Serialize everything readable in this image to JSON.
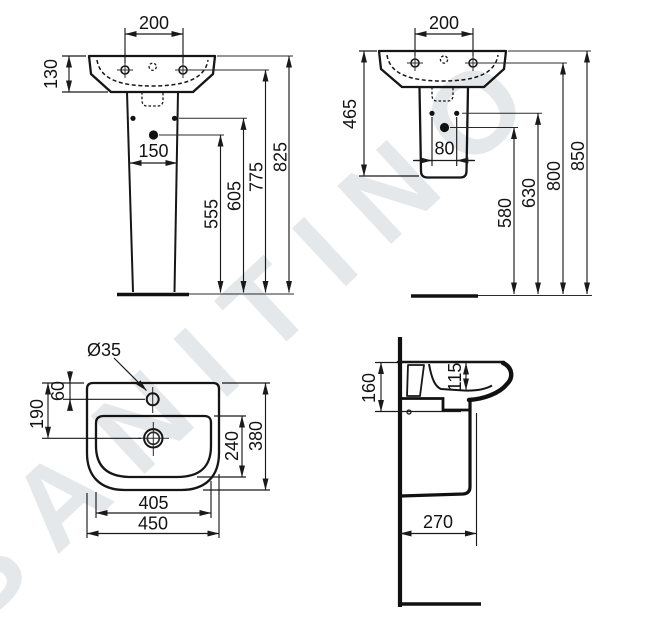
{
  "watermark": "SANITINO",
  "drawing": {
    "front_view": {
      "dims": {
        "hole_spacing": "200",
        "basin_height": "130",
        "pedestal_hole_spacing": "150",
        "trap_height": "555",
        "pedestal_holes_height": "605",
        "rim_holes_height": "775",
        "overall_height": "825"
      }
    },
    "semi_view": {
      "dims": {
        "hole_spacing": "200",
        "unit_height": "465",
        "pedestal_hole_spacing": "80",
        "trap_height": "580",
        "pedestal_holes_height": "630",
        "rim_holes_height": "800",
        "overall_height": "850"
      }
    },
    "top_view": {
      "dims": {
        "tap_hole_diameter": "Ø35",
        "tap_hole_offset": "60",
        "drain_offset": "190",
        "bowl_depth": "240",
        "overall_depth": "380",
        "bowl_width": "405",
        "overall_width": "450"
      }
    },
    "side_view": {
      "dims": {
        "basin_height": "160",
        "bowl_inner_depth": "115",
        "front_projection": "270"
      }
    }
  }
}
